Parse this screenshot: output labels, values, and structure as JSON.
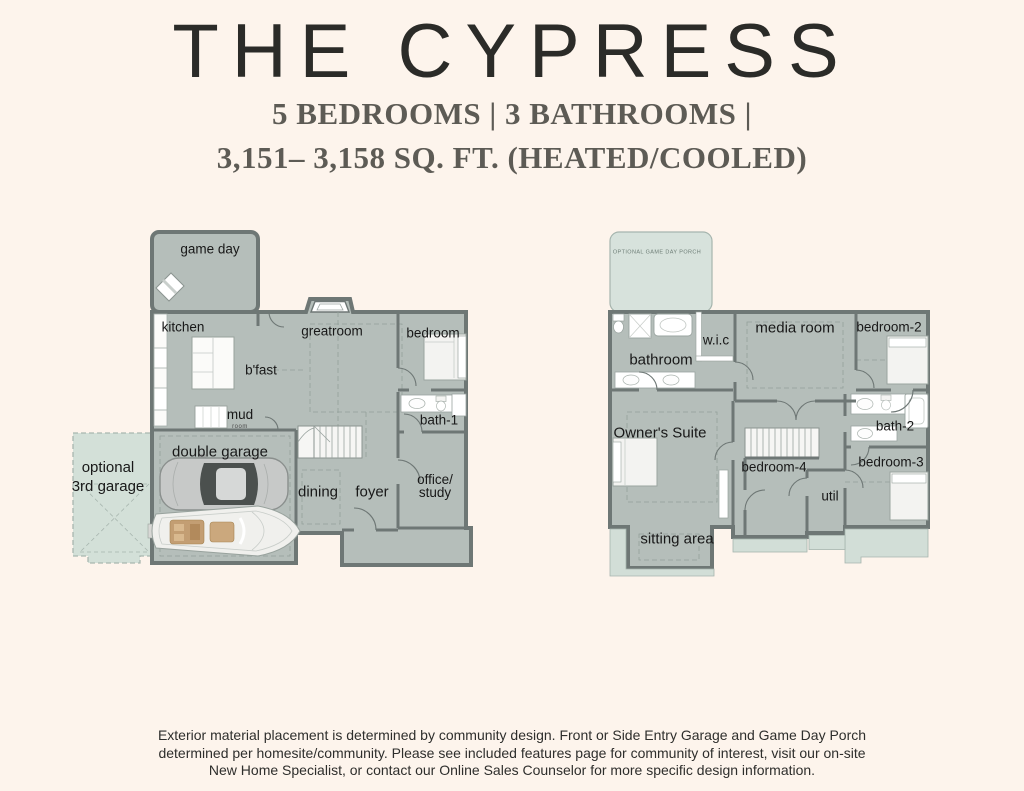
{
  "page": {
    "background_color": "#fdf4ec"
  },
  "header": {
    "title": "THE CYPRESS",
    "subtitle_line1": "5 BEDROOMS | 3 BATHROOMS |",
    "subtitle_line2": "3,151– 3,158 SQ. FT. (HEATED/COOLED)"
  },
  "floor1": {
    "labels": {
      "game_day": "game day",
      "kitchen": "kitchen",
      "greatroom": "greatroom",
      "bedroom": "bedroom",
      "bfast": "b'fast",
      "mud": "mud",
      "mud_sub": "room",
      "bath1": "bath-1",
      "double_garage": "double garage",
      "optional_garage_line1": "optional",
      "optional_garage_line2": "3rd garage",
      "dining": "dining",
      "foyer": "foyer",
      "office_line1": "office/",
      "office_line2": "study"
    }
  },
  "floor2": {
    "labels": {
      "porch_note": "OPTIONAL GAME DAY PORCH",
      "bathroom": "bathroom",
      "wic": "w.i.c",
      "media_room": "media room",
      "bedroom2": "bedroom-2",
      "owners_suite": "Owner's Suite",
      "bedroom4": "bedroom-4",
      "bath2": "bath-2",
      "bedroom3": "bedroom-3",
      "util": "util",
      "sitting_area": "sitting area"
    }
  },
  "footer": {
    "line1": "Exterior material placement is determined by community design. Front or Side Entry Garage and Game Day Porch",
    "line2": "determined per homesite/community. Please see included features page for community of interest, visit our on-site",
    "line3": "New Home Specialist, or contact our Online Sales Counselor for more specific design information."
  },
  "colors": {
    "background": "#fdf4ec",
    "plan_fill": "#b5beba",
    "wall": "#6e7775",
    "optional_area": "#d3e0d8",
    "label_text": "#1a1a1a"
  }
}
